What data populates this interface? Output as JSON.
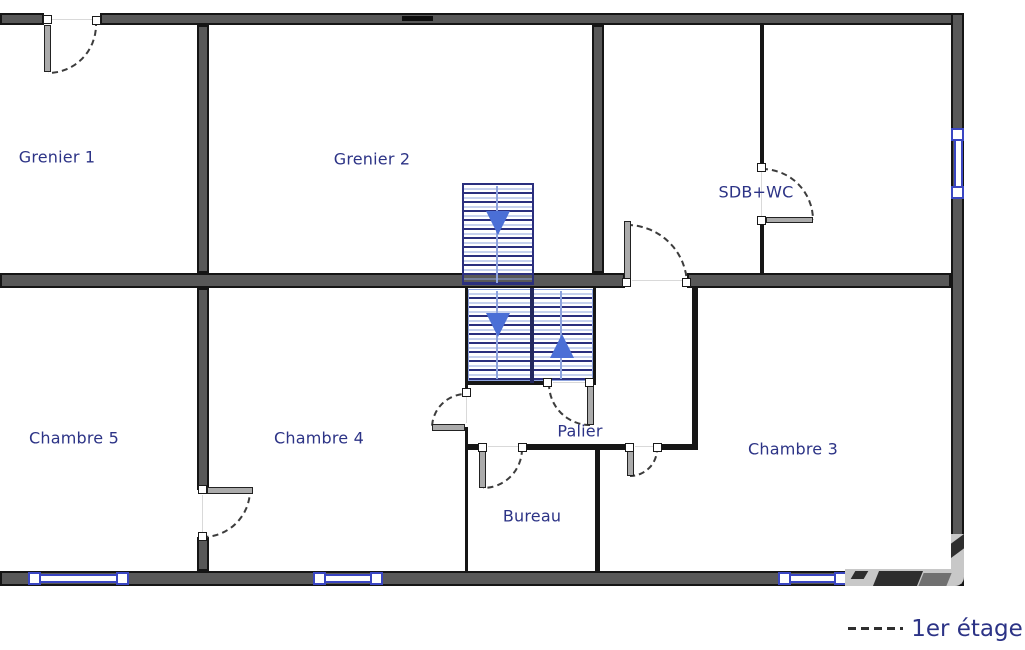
{
  "rooms": {
    "grenier1": "Grenier 1",
    "grenier2": "Grenier 2",
    "sdb_wc": "SDB+WC",
    "chambre5": "Chambre 5",
    "chambre4": "Chambre 4",
    "chambre3": "Chambre 3",
    "palier": "Palier",
    "bureau": "Bureau"
  },
  "legend": {
    "floor": "1er étage"
  },
  "icons": {
    "stairs_down_arrow": "triangle-down",
    "stairs_up_arrow": "triangle-up"
  },
  "colors": {
    "label_navy": "#2c3386",
    "stair_navy": "#2b2f7e",
    "stair_light": "#8ea3de",
    "arrow_blue": "#4b6fd6",
    "window_blue": "#3a46c2",
    "wall_gray": "#585858",
    "wall_edge": "#151515"
  }
}
